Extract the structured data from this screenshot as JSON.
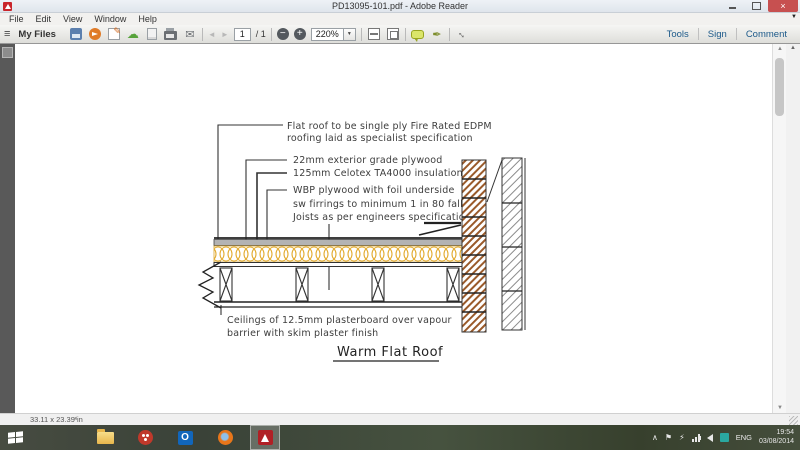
{
  "window": {
    "title": "PD13095-101.pdf - Adobe Reader"
  },
  "menubar": {
    "items": [
      "File",
      "Edit",
      "View",
      "Window",
      "Help"
    ]
  },
  "toolbar": {
    "my_files_label": "My Files",
    "page_current": "1",
    "page_total_label": "/ 1",
    "zoom_value": "220%",
    "tools_label": "Tools",
    "sign_label": "Sign",
    "comment_label": "Comment"
  },
  "icons": {
    "hamburger": "≡",
    "cloud": "☁",
    "mail": "✉",
    "back": "◄",
    "forward": "►",
    "minus": "−",
    "plus": "+",
    "caret_down": "▼",
    "pen": "✒",
    "expand": "↔",
    "collapse": "▲",
    "overflow": "▼",
    "scroll_up": "▲",
    "scroll_down": "▼",
    "status_arrow": "◄",
    "close": "×",
    "tray_chevron": "∧",
    "tray_flag": "⚑",
    "tray_power": "⚡",
    "outlook_o": "O"
  },
  "drawing": {
    "annotation_flat_roof_1": "Flat roof to be single ply Fire Rated EDPM",
    "annotation_flat_roof_2": "roofing laid as specialist specification",
    "annotation_plywood": "22mm exterior grade plywood",
    "annotation_insulation": "125mm Celotex TA4000 insulation",
    "annotation_wbp": "WBP plywood with foil underside",
    "annotation_firrings": "sw firrings to minimum 1 in 80 fall",
    "annotation_joists": "Joists as per engineers specification",
    "annotation_ceiling_1": "Ceilings of 12.5mm plasterboard over vapour",
    "annotation_ceiling_2": "barrier with skim plaster finish",
    "title": "Warm Flat Roof",
    "colors": {
      "insulation": "#e2aa2e",
      "brick": "#9a5a2a",
      "block": "#8c8c8c"
    }
  },
  "statusbar": {
    "dimensions": "33.11 x 23.39 in"
  },
  "taskbar": {
    "language": "ENG",
    "time": "19:54",
    "date": "03/08/2014"
  }
}
